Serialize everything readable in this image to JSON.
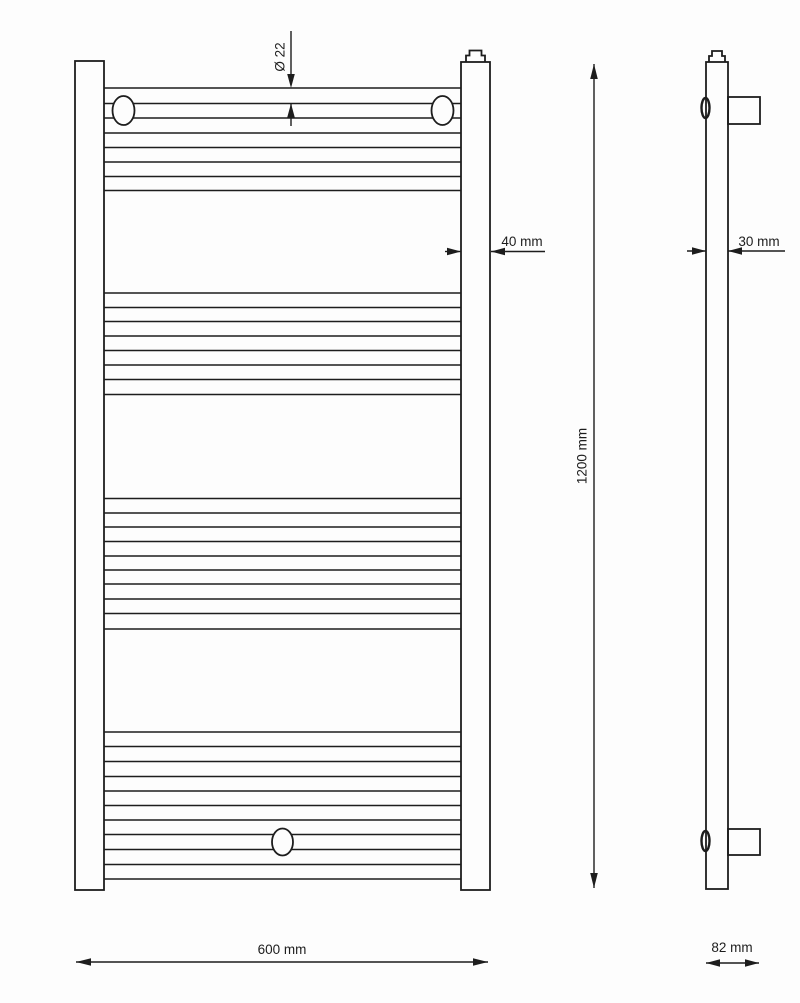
{
  "drawing": {
    "type": "technical-dimension-drawing",
    "subject": "towel-rail-radiator",
    "colors": {
      "line": "#1d1d1d",
      "background": "#fdfdfd"
    },
    "front_view": {
      "dim_tube_diameter": "Ø 22",
      "dim_rail_width": "40 mm",
      "dim_height": "1200 mm",
      "dim_width": "600 mm",
      "tube_line_x": [
        104,
        461
      ],
      "tube_line_ys": [
        88,
        103.5,
        118,
        133,
        147.5,
        162,
        176.5,
        190.5,
        293,
        307.5,
        321.5,
        336,
        350.5,
        365,
        379.5,
        394.5,
        498.5,
        513,
        527,
        541.5,
        556,
        570,
        584,
        599,
        613.5,
        629,
        732,
        746.5,
        761.5,
        776.5,
        791,
        805.5,
        820,
        834.5,
        849.5,
        864.5,
        879
      ],
      "tube_groups": [
        8,
        8,
        10,
        11
      ]
    },
    "side_view": {
      "dim_depth": "30 mm",
      "dim_total_depth": "82 mm"
    }
  }
}
